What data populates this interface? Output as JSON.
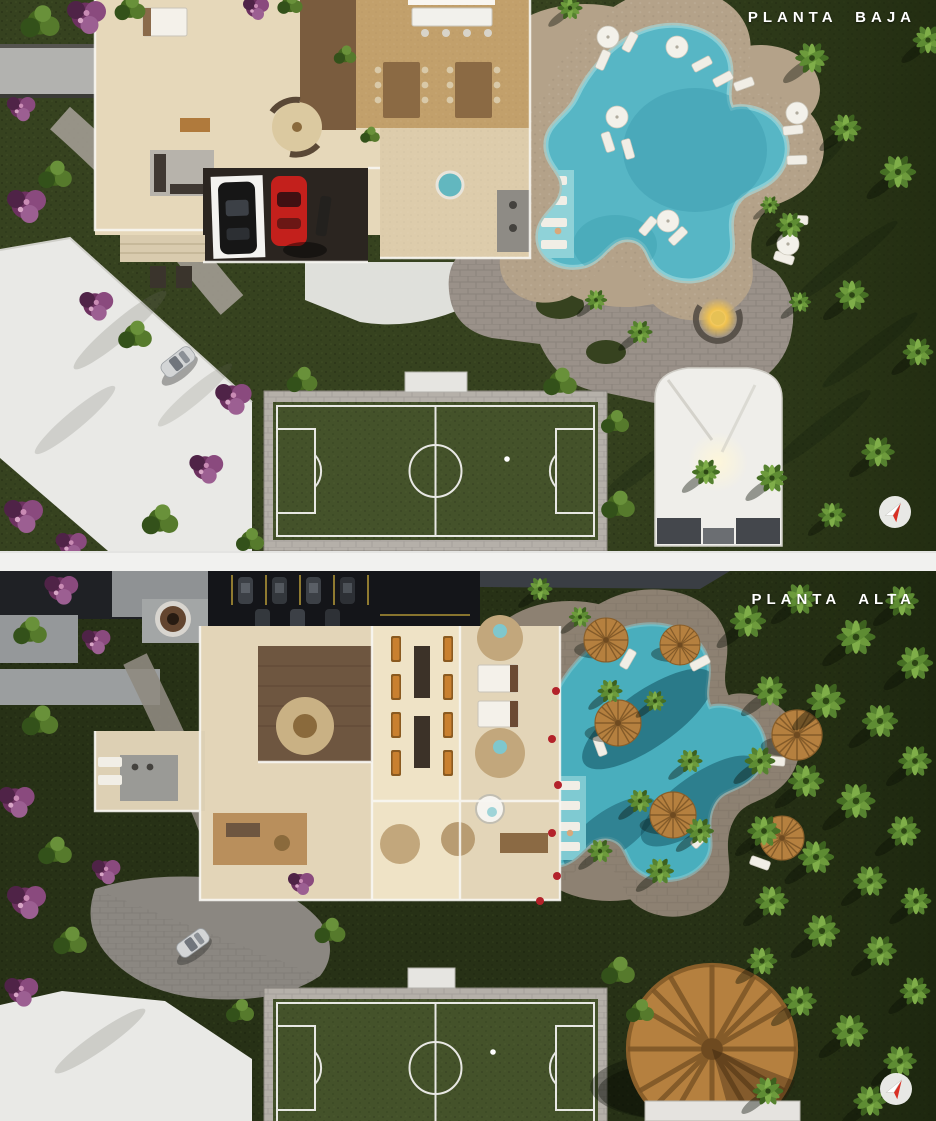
{
  "view": {
    "type": "architectural-site-plan-render",
    "panels": [
      {
        "id": "planta-baja",
        "label": "PLANTA BAJA"
      },
      {
        "id": "planta-alta",
        "label": "PLANTA ALTA"
      }
    ]
  },
  "icons": {
    "compass": "compass-needle-icon"
  },
  "colors": {
    "label_text": "#ffffff",
    "grass": "#36421f",
    "grass_dark": "#243012",
    "pool_water": "#57b6c5",
    "pool_ledge": "#8fd2d8",
    "pool_shadow": "#11505f",
    "deck_sand": "#b4a289",
    "deck_upper": "#8d8172",
    "pavers": "#9a9189",
    "driveway": "#e9e9e6",
    "floor_beige": "#e6d8ba",
    "wood_floor": "#c2a06b",
    "roof_dark": "#17181c",
    "carport_line_yellow": "#c9a93c",
    "thatch": "#b5803f",
    "field_green": "#44522a",
    "field_border": "#b5b0a9",
    "field_line": "#e8e8e4",
    "car_red": "#c3201c",
    "car_black": "#161616",
    "car_silver": "#d3d5d6",
    "compass_red": "#d93025",
    "divider": "#f1f1ef"
  }
}
